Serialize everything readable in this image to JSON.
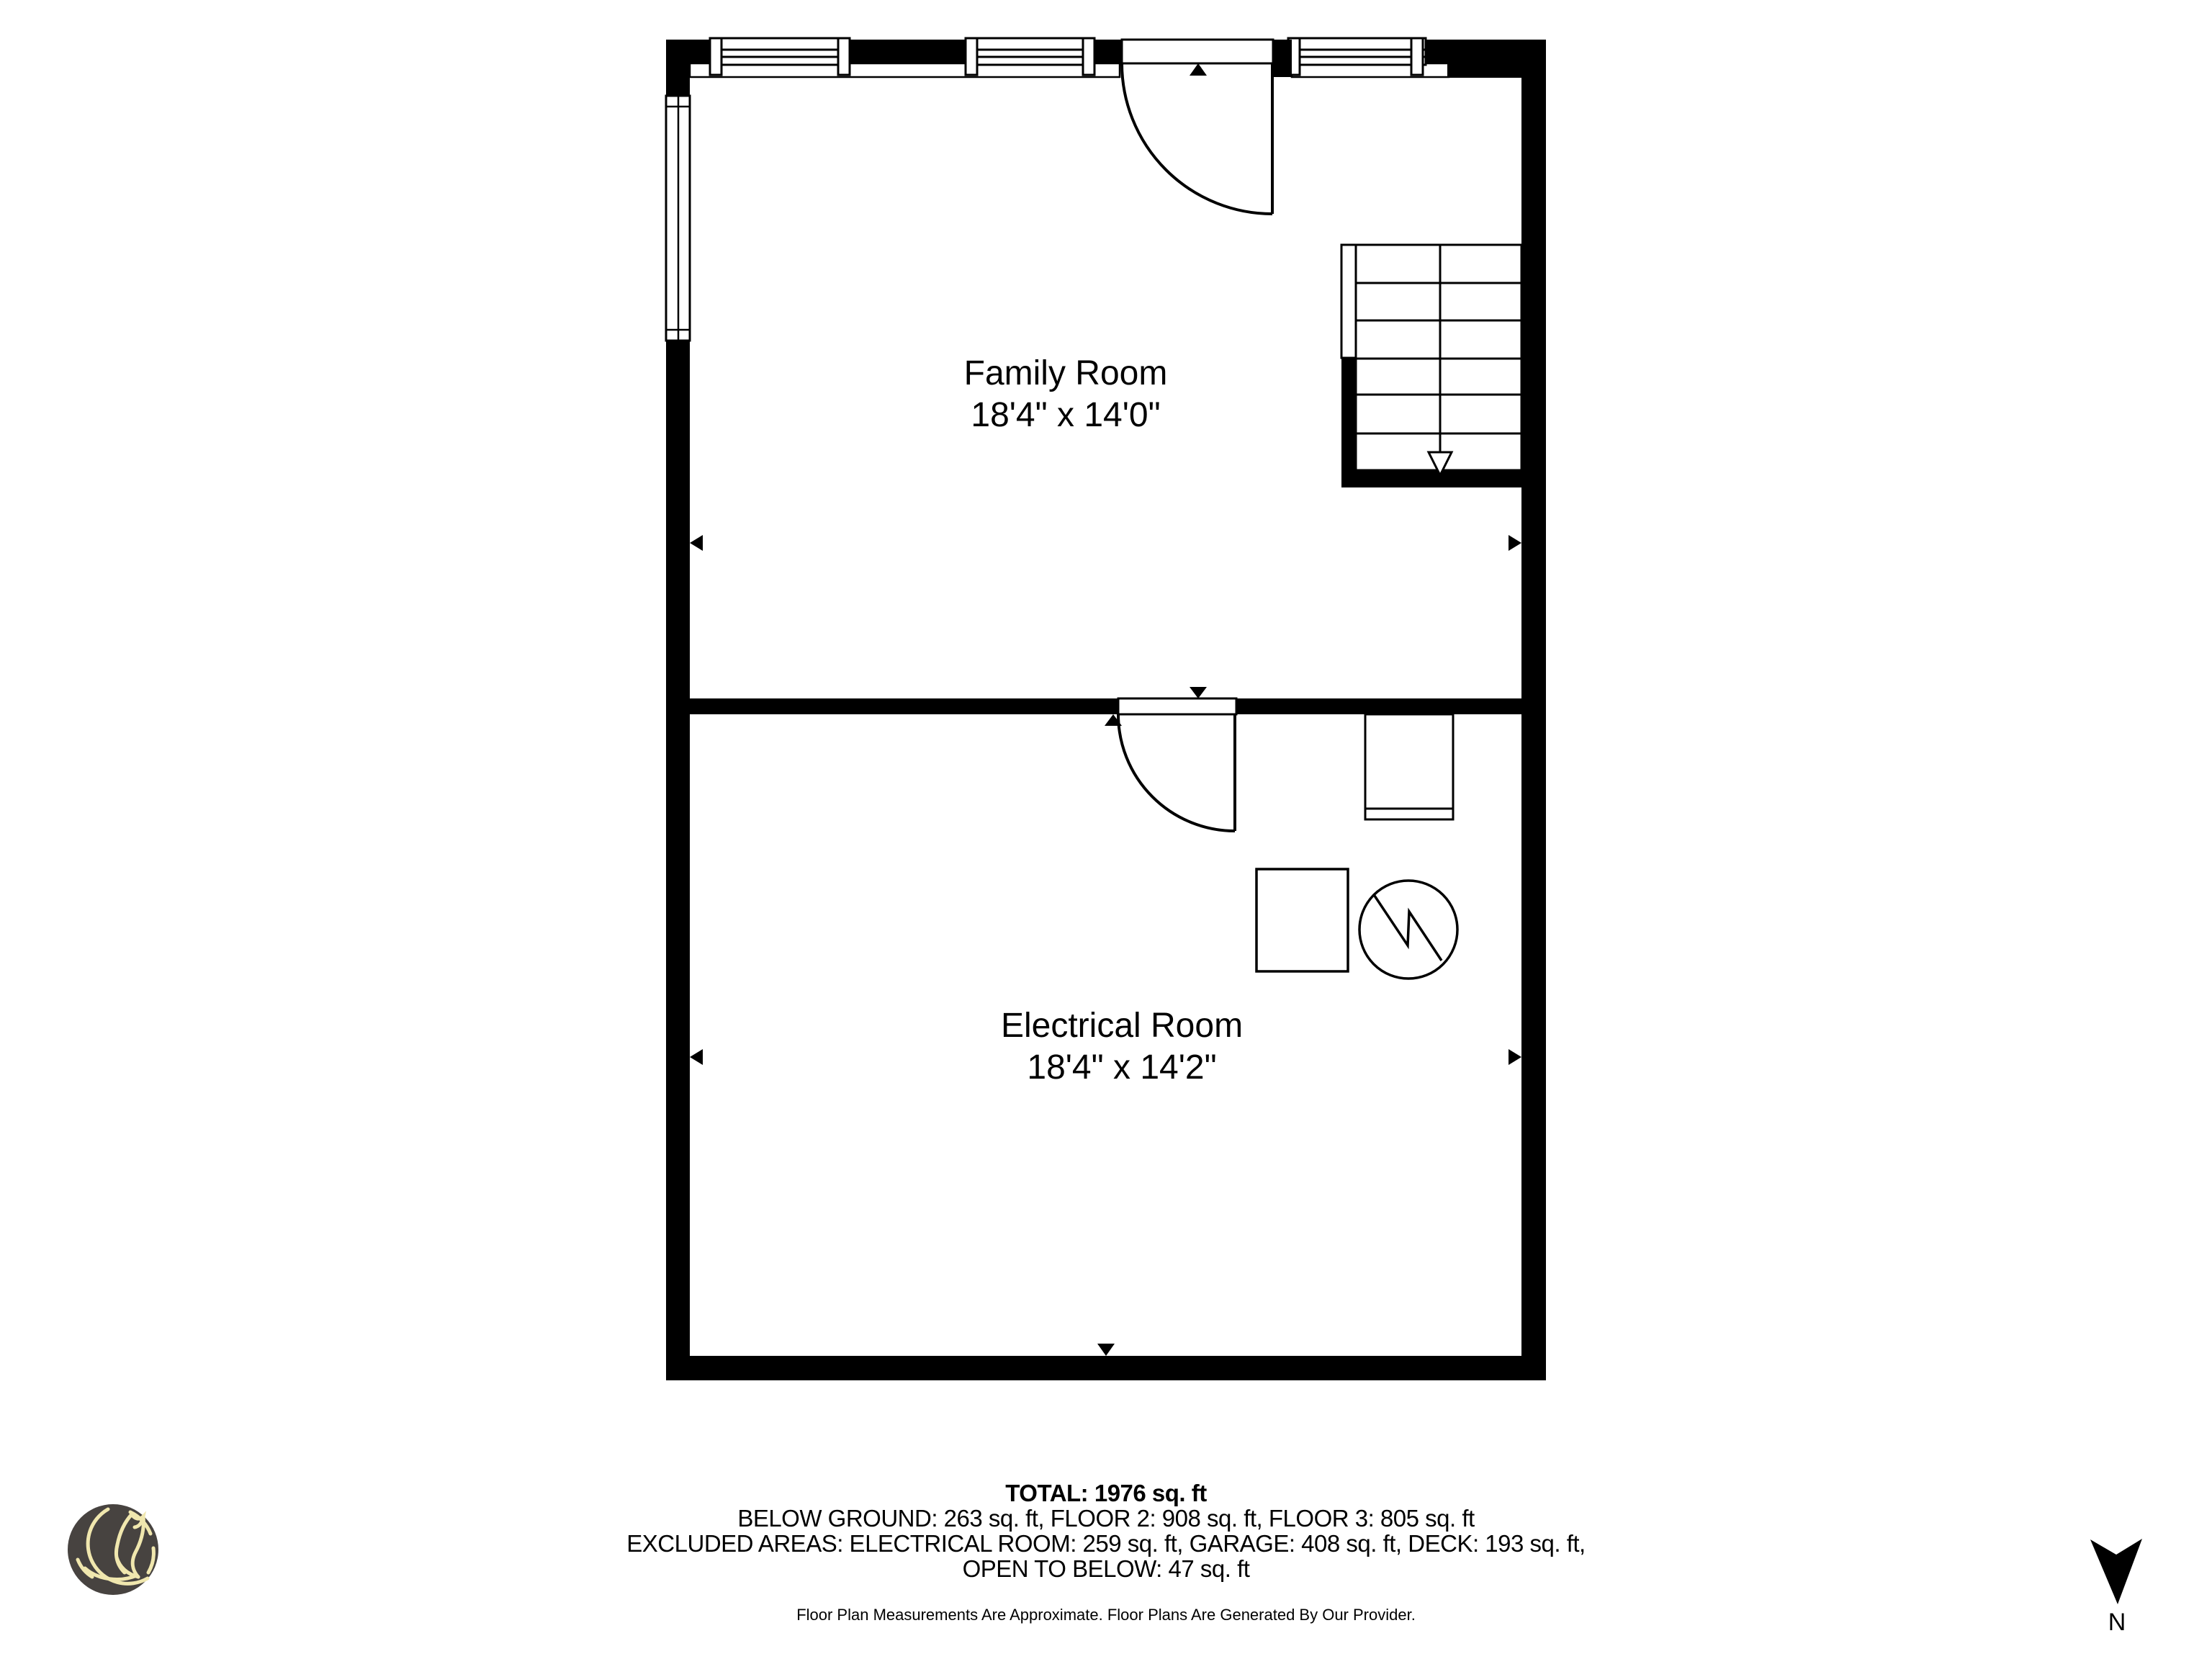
{
  "plan": {
    "rooms": [
      {
        "name": "Family Room",
        "dimensions": "18'4\" x 14'0\""
      },
      {
        "name": "Electrical Room",
        "dimensions": "18'4\" x 14'2\""
      }
    ]
  },
  "footer": {
    "total": "TOTAL: 1976 sq. ft",
    "line2": "BELOW GROUND: 263 sq. ft, FLOOR 2: 908 sq. ft, FLOOR 3: 805 sq. ft",
    "line3": "EXCLUDED AREAS: ELECTRICAL ROOM: 259 sq. ft, GARAGE: 408 sq. ft, DECK: 193 sq. ft,",
    "line4": "OPEN TO BELOW: 47 sq. ft",
    "disclaimer": "Floor Plan Measurements Are Approximate. Floor Plans Are Generated By Our Provider."
  },
  "compass": {
    "label": "N"
  },
  "colors": {
    "wall": "#000000",
    "logo_background": "#474340",
    "logo_line": "#f0e7ae"
  }
}
